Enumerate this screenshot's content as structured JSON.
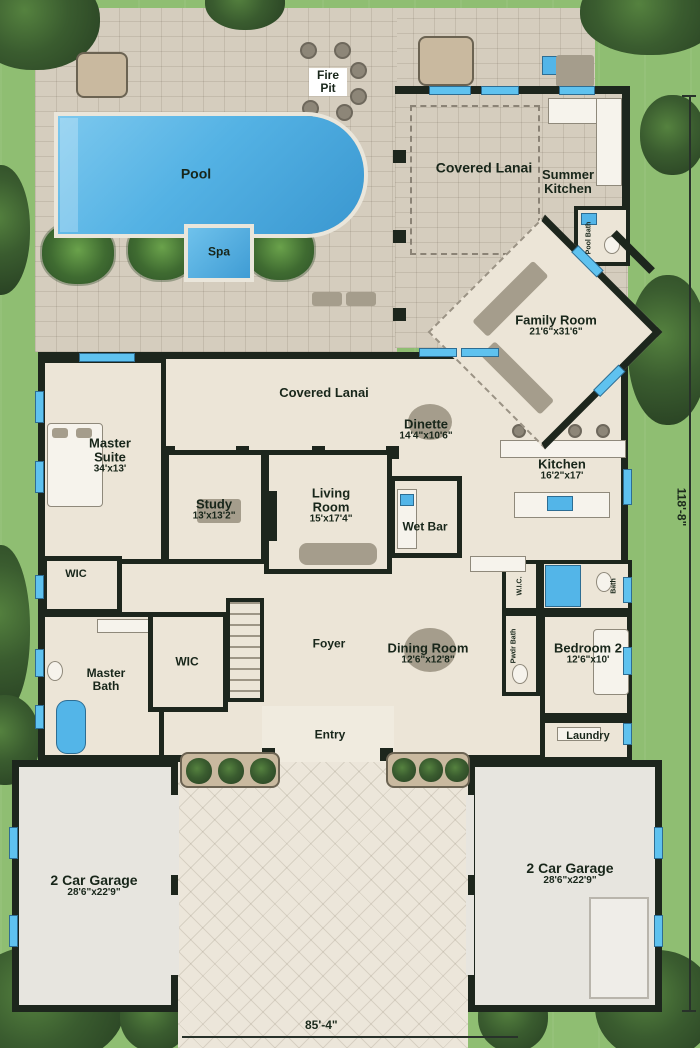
{
  "rooms": {
    "fire_pit": {
      "label": "Fire Pit"
    },
    "pool": {
      "label": "Pool"
    },
    "spa": {
      "label": "Spa"
    },
    "covered_lanai_top": {
      "label": "Covered Lanai"
    },
    "summer_kitchen": {
      "label": "Summer Kitchen"
    },
    "pool_bath": {
      "label": "Pool Bath"
    },
    "family_room": {
      "label": "Family Room",
      "dims": "21'6\"x31'6\""
    },
    "covered_lanai_mid": {
      "label": "Covered Lanai"
    },
    "dinette": {
      "label": "Dinette",
      "dims": "14'4\"x10'6\""
    },
    "master_suite": {
      "label": "Master Suite",
      "dims": "34'x13'"
    },
    "study": {
      "label": "Study",
      "dims": "13'x13'2\""
    },
    "living_room": {
      "label": "Living Room",
      "dims": "15'x17'4\""
    },
    "wet_bar": {
      "label": "Wet Bar"
    },
    "kitchen": {
      "label": "Kitchen",
      "dims": "16'2\"x17'"
    },
    "wic_master": {
      "label": "WIC"
    },
    "master_bath": {
      "label": "Master Bath"
    },
    "wic_hall": {
      "label": "WIC"
    },
    "foyer": {
      "label": "Foyer"
    },
    "dining_room": {
      "label": "Dining Room",
      "dims": "12'6\"x12'8\""
    },
    "wic_bed2": {
      "label": "W.I.C."
    },
    "bath_bed2": {
      "label": "Bath"
    },
    "pwdr_bath": {
      "label": "Pwdr Bath"
    },
    "bedroom2": {
      "label": "Bedroom 2",
      "dims": "12'6\"x10'"
    },
    "entry": {
      "label": "Entry"
    },
    "laundry": {
      "label": "Laundry"
    },
    "garage_left": {
      "label": "2 Car Garage",
      "dims": "28'6\"x22'9\""
    },
    "garage_right": {
      "label": "2 Car Garage",
      "dims": "28'6\"x22'9\""
    }
  },
  "dimensions": {
    "width_label": "85'-4\"",
    "depth_label": "118'-8\""
  },
  "palette": {
    "grass": "#8fbe72",
    "foliage": "#33502c",
    "deck_paver": "#d5cdbe",
    "wall": "#1d261d",
    "interior_floor": "#ece5d7",
    "pool_water": "#54b2e4",
    "window": "#5fc2ef",
    "label_text": "#18261a",
    "driveway": "#ece6da"
  }
}
